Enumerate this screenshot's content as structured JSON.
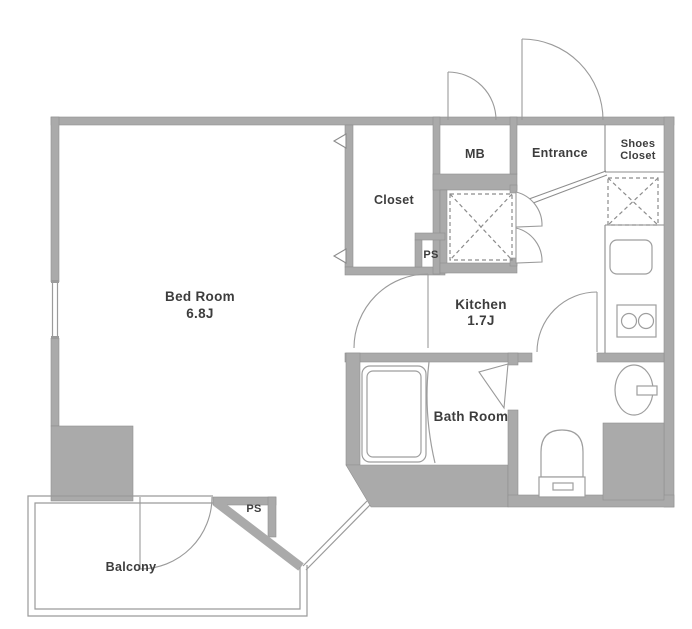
{
  "plan": {
    "type": "apartment-floor-plan",
    "colors": {
      "wall": "#AAAAAA",
      "wall_edge": "#8F8F8F",
      "line": "#8C8C8C",
      "fixture": "#9E9E9E",
      "text": "#3D3D3D"
    },
    "rooms": {
      "bedroom": {
        "name": "Bed Room",
        "size": "6.8J"
      },
      "kitchen": {
        "name": "Kitchen",
        "size": "1.7J"
      },
      "closet": {
        "name": "Closet"
      },
      "meter_box": {
        "name": "MB"
      },
      "entrance": {
        "name": "Entrance"
      },
      "shoes_closet": {
        "line1": "Shoes",
        "line2": "Closet"
      },
      "pipe_shaft_upper": {
        "name": "PS"
      },
      "pipe_shaft_lower": {
        "name": "PS"
      },
      "bathroom": {
        "name": "Bath Room"
      },
      "balcony": {
        "name": "Balcony"
      }
    }
  }
}
